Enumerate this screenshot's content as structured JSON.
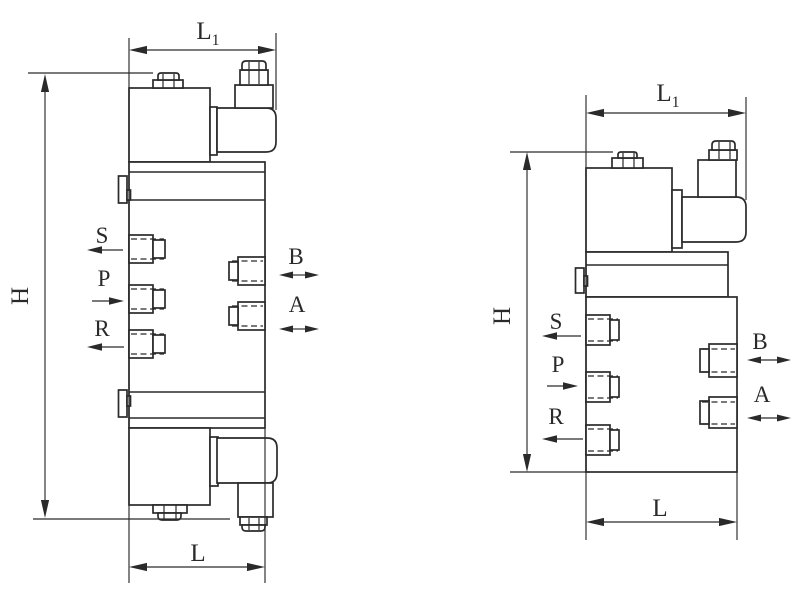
{
  "colors": {
    "line": "#2a2a2a",
    "background": "#ffffff"
  },
  "left_valve": {
    "view": "double solenoid valve side view",
    "dim_width_top": "L",
    "dim_width_top_sub": "1",
    "dim_height": "H",
    "dim_width_bottom": "L",
    "port_s": "S",
    "port_p": "P",
    "port_r": "R",
    "port_b": "B",
    "port_a": "A"
  },
  "right_valve": {
    "view": "single solenoid valve side view",
    "dim_width_top": "L",
    "dim_width_top_sub": "1",
    "dim_height": "H",
    "dim_width_bottom": "L",
    "port_s": "S",
    "port_p": "P",
    "port_r": "R",
    "port_b": "B",
    "port_a": "A"
  }
}
